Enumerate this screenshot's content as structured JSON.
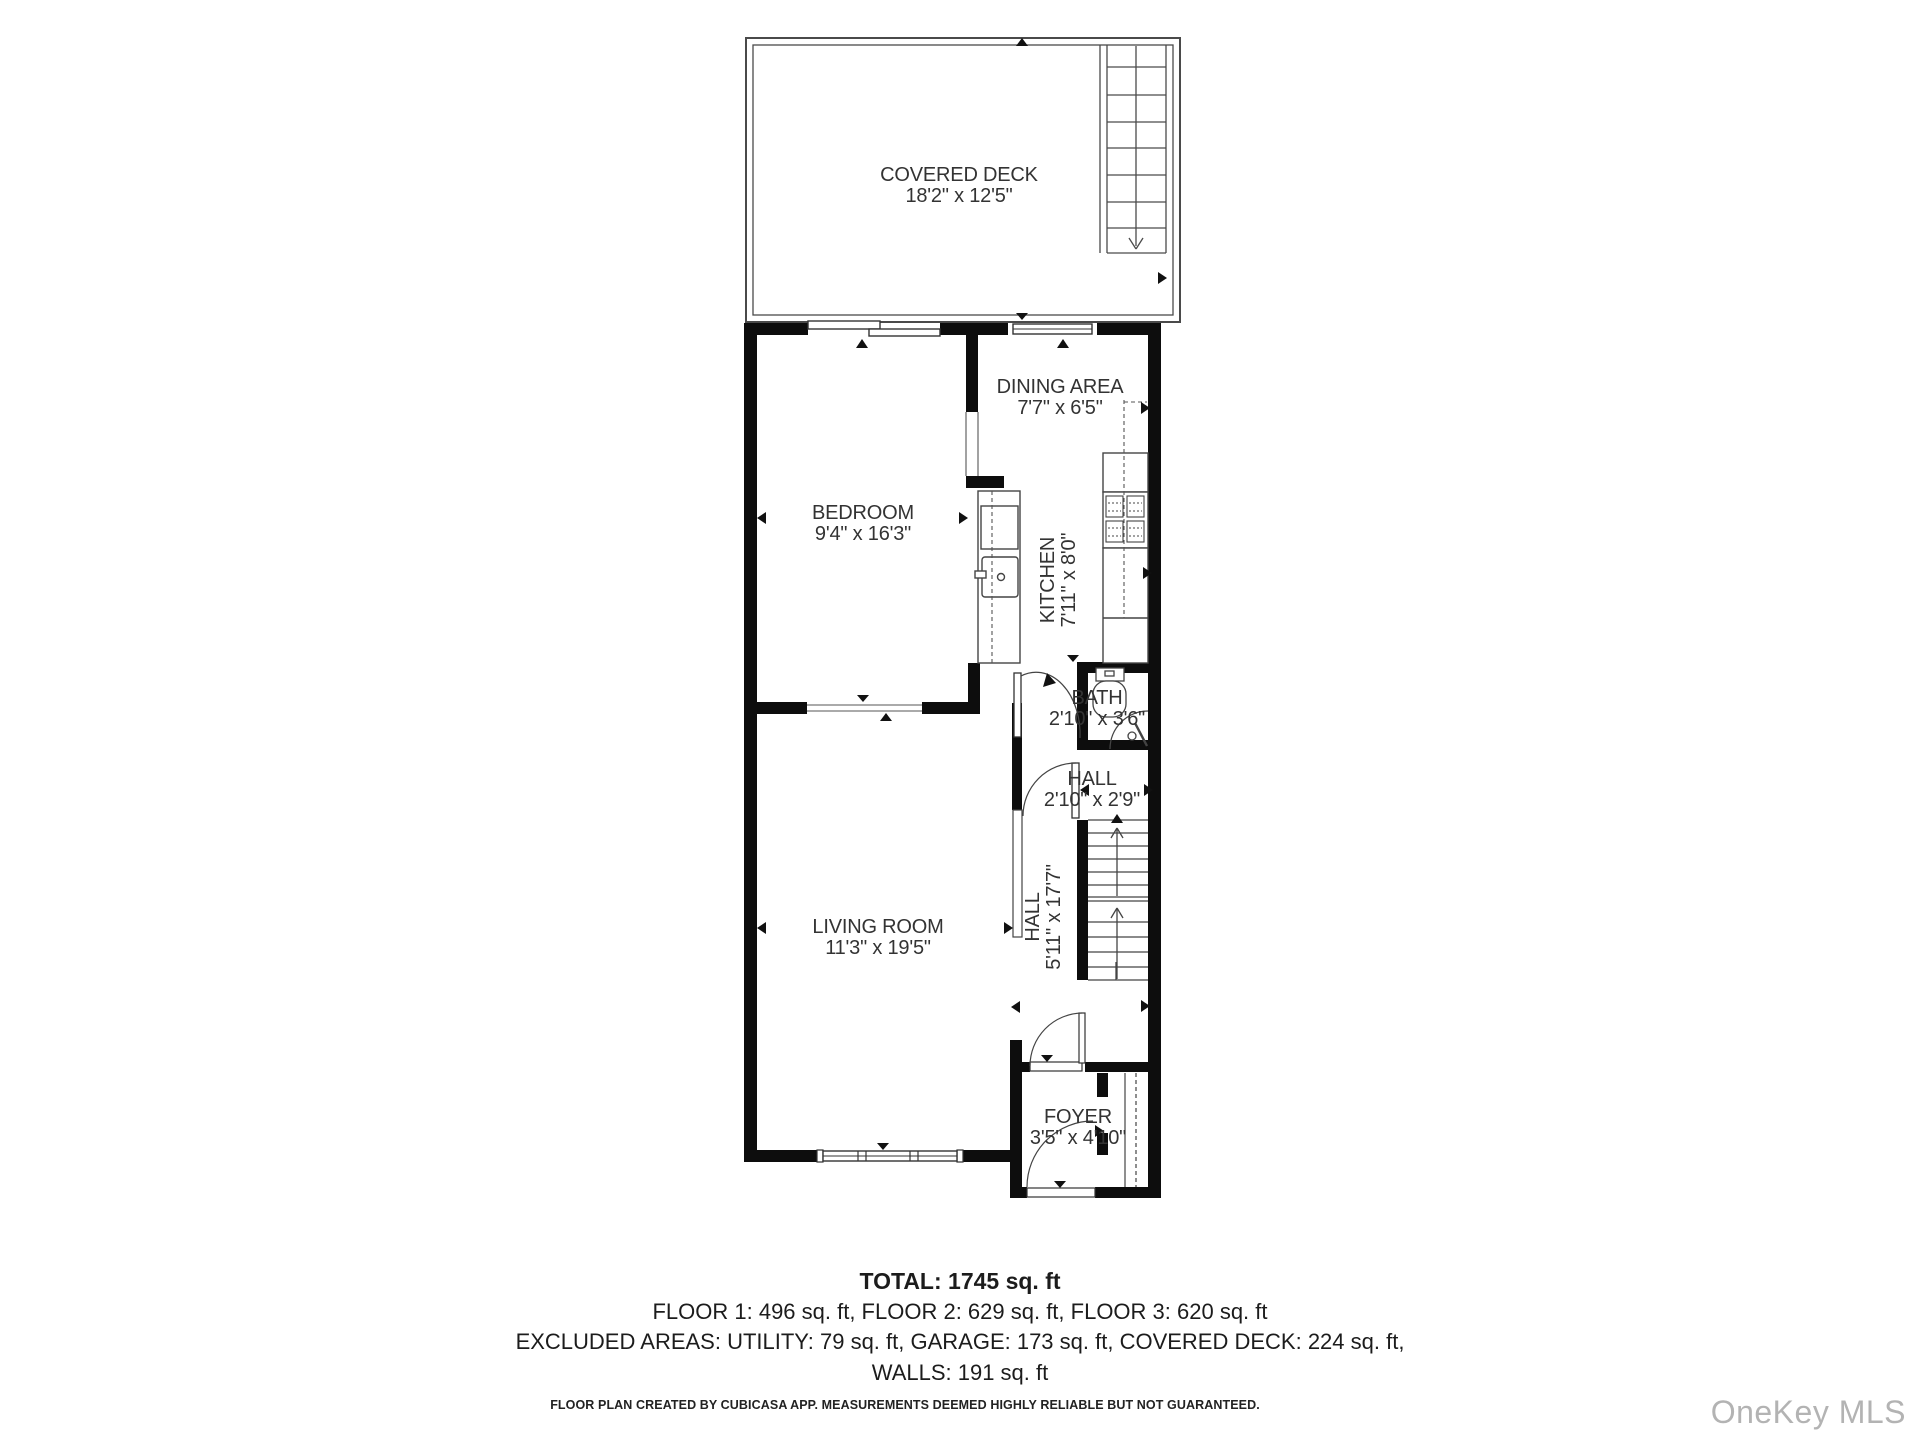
{
  "plan": {
    "rooms": [
      {
        "name": "COVERED DECK",
        "dims": "18'2\" x 12'5\""
      },
      {
        "name": "DINING AREA",
        "dims": "7'7\" x 6'5\""
      },
      {
        "name": "BEDROOM",
        "dims": "9'4\" x 16'3\""
      },
      {
        "name": "KITCHEN",
        "dims": "7'11\" x 8'0\""
      },
      {
        "name": "BATH",
        "dims": "2'10\" x 3'6\""
      },
      {
        "name": "HALL",
        "dims": "2'10\" x 2'9\""
      },
      {
        "name": "HALL",
        "dims": "5'11\" x 17'7\""
      },
      {
        "name": "LIVING ROOM",
        "dims": "11'3\" x 19'5\""
      },
      {
        "name": "FOYER",
        "dims": "3'5\" x 4'10\""
      }
    ],
    "summary": {
      "total": "TOTAL: 1745 sq. ft",
      "floors": "FLOOR 1: 496 sq. ft, FLOOR 2: 629 sq. ft, FLOOR 3: 620 sq. ft",
      "excluded": "EXCLUDED AREAS: UTILITY: 79 sq. ft, GARAGE: 173 sq. ft, COVERED DECK: 224 sq. ft,",
      "walls": "WALLS: 191 sq. ft"
    },
    "footer": "FLOOR PLAN CREATED BY CUBICASA APP. MEASUREMENTS DEEMED HIGHLY RELIABLE BUT NOT GUARANTEED.",
    "watermark": "OneKey MLS"
  }
}
